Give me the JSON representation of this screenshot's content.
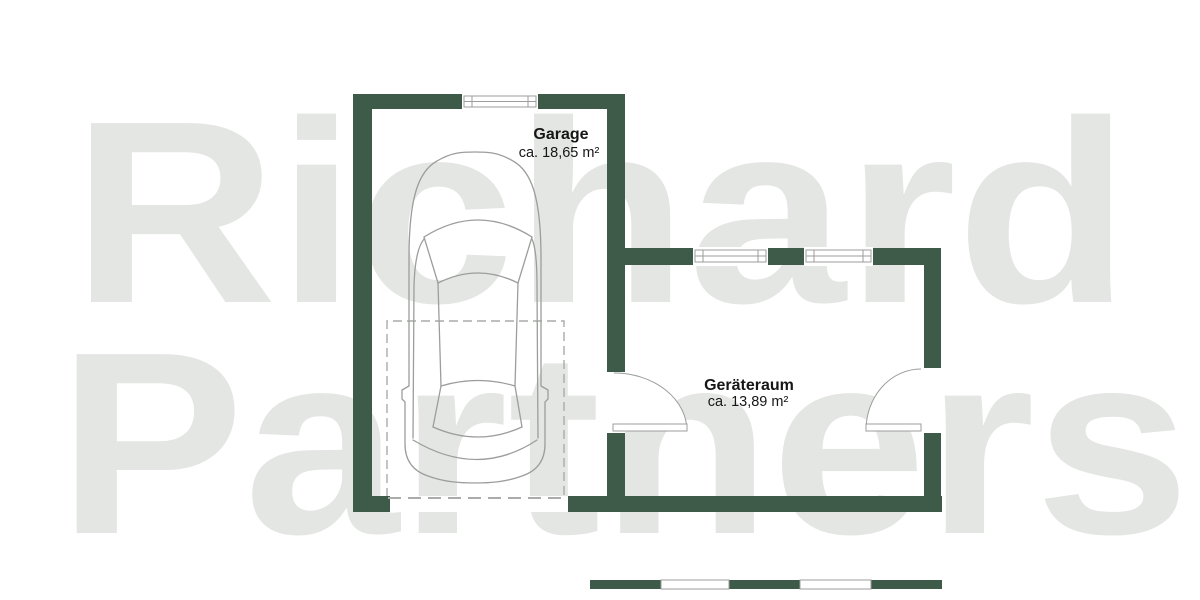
{
  "watermark": {
    "line1": "Richard",
    "line2": "Partners"
  },
  "rooms": [
    {
      "name": "Garage",
      "area": "ca. 18,65 m²"
    },
    {
      "name": "Geräteraum",
      "area": "ca. 13,89 m²"
    }
  ],
  "colors": {
    "background": "#FFFFFF",
    "wall-green": "#3E5B4A",
    "watermark-gray": "#E4E6E3",
    "line-gray": "#9B9E9B",
    "dash-gray": "#A9ACA9",
    "text-dark": "#161616"
  }
}
